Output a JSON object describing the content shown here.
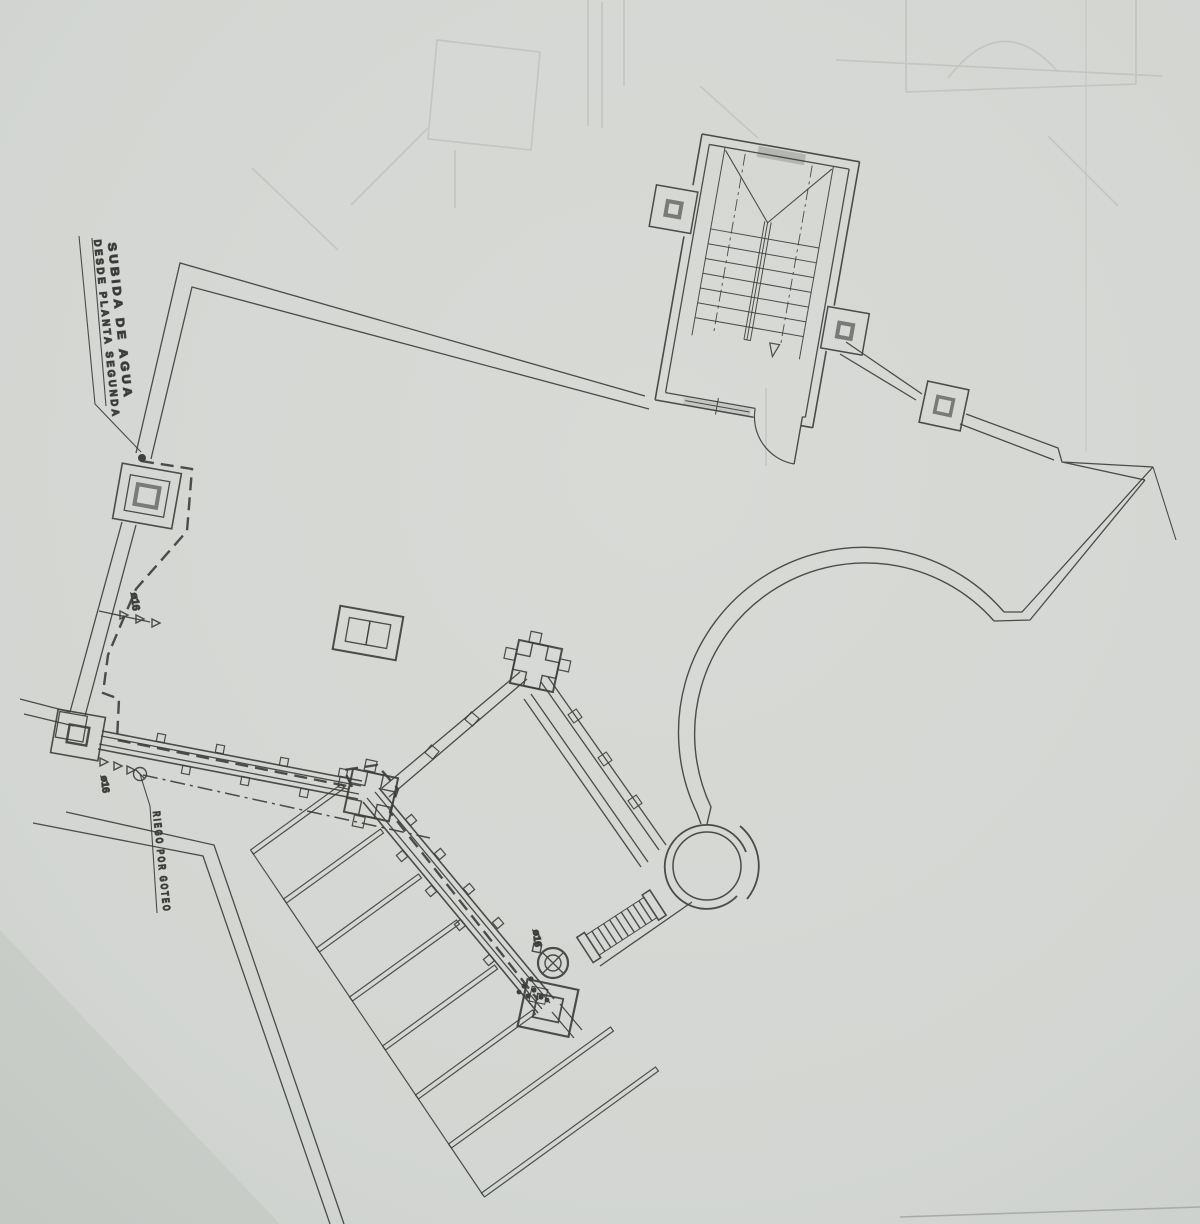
{
  "plan": {
    "labels": {
      "water_riser": {
        "line1": "SUBIDA DE AGUA",
        "line2": "DESDE PLANTA SEGUNDA"
      },
      "drip_irrigation": "RIEGO POR GOTEO",
      "pipe_dia_left": "ø16",
      "pipe_dia_bottom_left": "ø16",
      "pipe_dia_center": "ø16"
    },
    "colors": {
      "paper": "#d4d7d3",
      "paper_edge": "#cdd1cd",
      "ink": "#3d403c",
      "ink_soft": "#6f726e",
      "ghost": "#9aa09b"
    }
  }
}
